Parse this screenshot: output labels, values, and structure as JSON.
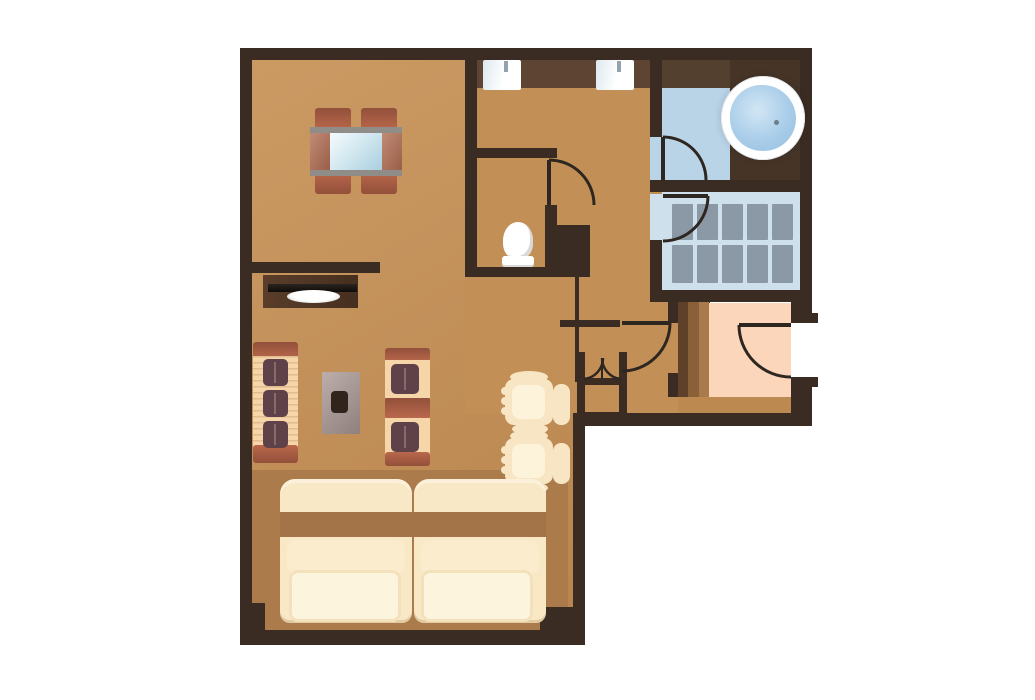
{
  "diagram": {
    "type": "floor-plan",
    "subject": "one-bedroom apartment / hotel suite, top-down view",
    "text_labels": []
  },
  "palette": {
    "background": "#ffffff",
    "wall": "#3b2c23",
    "floor": "#c29057",
    "floor_entry_strip": "#bc8951",
    "bed_platform": "#ab7b4b",
    "vanity_counter": "#5d4433",
    "bath_counter": "#53402f",
    "tub_deck": "#463527",
    "bath_floor": "#b9d3e7",
    "tile_room_floor": "#cfe0ed",
    "tile": "#8b99a7",
    "entry_floor_pink": "#fbd6bb",
    "wood_planks": [
      "#5f4129",
      "#8a6038",
      "#a87a4c"
    ],
    "brick_furniture": "#a85c40",
    "sofa_cream": "#f6d6a8",
    "cushion_maroon": "#5e4149",
    "lounge_cream": "#f7e5c3",
    "bed_cream": "#f9e8c6",
    "pillow_cream": "#fdf4de",
    "blanket_band": "#a27447",
    "tub_water": "#a9cde9",
    "door_line": "#2e2620",
    "fixture_white": "#ffffff"
  },
  "rooms": [
    {
      "id": "living-dining",
      "name": "living and dining room"
    },
    {
      "id": "sleeping-area",
      "name": "sleeping area with twin beds"
    },
    {
      "id": "hallway",
      "name": "hallway with vanity"
    },
    {
      "id": "wc",
      "name": "toilet room"
    },
    {
      "id": "bathroom",
      "name": "bathroom with round tub"
    },
    {
      "id": "shower-room",
      "name": "tiled shower / closet room"
    },
    {
      "id": "entry-hall",
      "name": "entrance hall"
    },
    {
      "id": "closet",
      "name": "bifold-door closet"
    }
  ],
  "furniture": {
    "dining_table": 1,
    "dining_chairs": 4,
    "tv_console": 1,
    "sofa_seats": 3,
    "armchairs_brick": 2,
    "side_table": 1,
    "coffee_table": 1,
    "lounge_chairs_cream": 2,
    "beds": 2,
    "pillows": 2,
    "toilet": 1,
    "sinks": 2,
    "bathtub_round": 1,
    "shower_tile_grid": {
      "cols": 5,
      "rows": 2
    }
  },
  "doors": [
    {
      "id": "wc-door",
      "swing": "into hallway"
    },
    {
      "id": "bathroom-door",
      "swing": "into bathroom"
    },
    {
      "id": "shower-room-door",
      "swing": "into shower room"
    },
    {
      "id": "hall-entry-door",
      "swing": "into hallway"
    },
    {
      "id": "entrance-door",
      "swing": "into entry hall, gap in right exterior wall"
    },
    {
      "id": "closet-bifold-doors",
      "swing": "double quarter arcs"
    }
  ]
}
